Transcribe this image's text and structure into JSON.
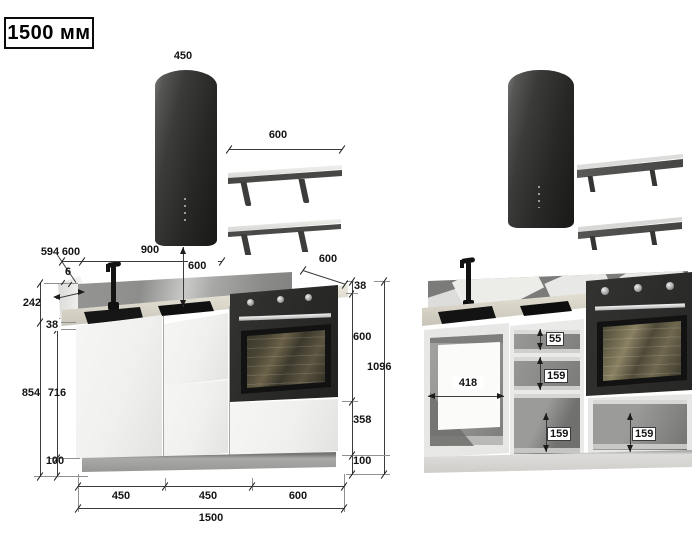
{
  "title": "1500 мм",
  "front_view": {
    "hood_width": "450",
    "shelf_width": "600",
    "depth_total": "594",
    "top_offset": "600",
    "sink_run": "900",
    "splash_thickness": "6",
    "hood_clearance": "600",
    "counter_depth": "600",
    "right_chain": {
      "counter": "38",
      "oven": "600",
      "base": "358",
      "plinth": "100",
      "total": "1096"
    },
    "left_chain": {
      "splash": "242",
      "counter": "38",
      "cabinet": "854",
      "inner": "716",
      "plinth": "100"
    },
    "bottom_chain": {
      "left": "450",
      "middle": "450",
      "right": "600",
      "total": "1500"
    }
  },
  "open_view": {
    "inner_width": "418",
    "top_drawer": "55",
    "middle_drawer": "159",
    "bottom_drawer": "159",
    "oven_drawer": "159"
  }
}
